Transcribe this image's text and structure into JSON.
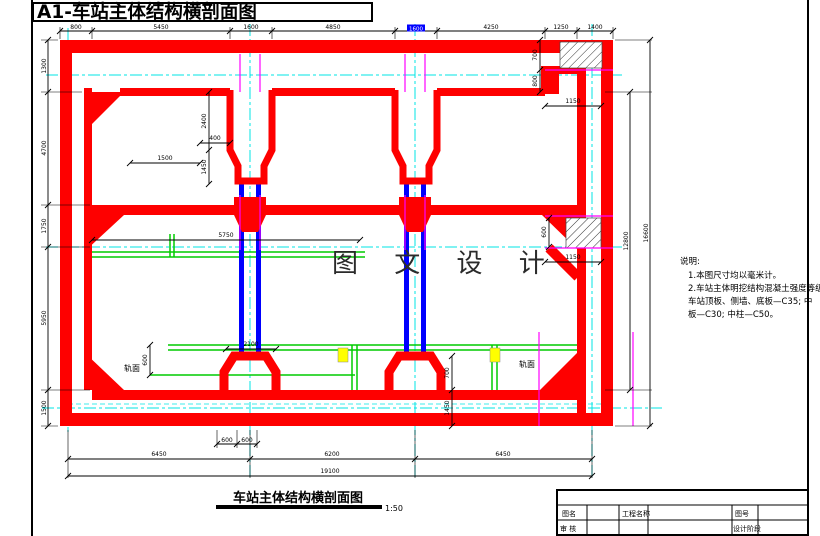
{
  "sheet": {
    "title": "A1-车站主体结构横剖面图",
    "caption": "车站主体结构横剖面图",
    "scale": "1:50",
    "watermark": "图 文 设 计"
  },
  "notes": {
    "heading": "说明:",
    "line1": "1.本图尺寸均以毫米计。",
    "line2": "2.车站主体明挖结构混凝土强度等级:",
    "line3": "车站顶板、侧墙、底板—C35; 中",
    "line4": "板—C30; 中柱—C50。"
  },
  "labels": {
    "rail_left": "轨面",
    "rail_right": "轨面"
  },
  "title_block": {
    "drawing_name": "图名",
    "project_name": "工程名称",
    "drawing_no": "图号",
    "review": "审 核",
    "design_stage": "设计阶段"
  },
  "colors": {
    "structure": "#fe0000",
    "column": "#0000fe",
    "centerline": "#00e5e5",
    "joint": "#ff00ff",
    "track": "#00cc00",
    "pad": "#ffff00"
  },
  "dimensions": {
    "top": [
      "800",
      "5450",
      "1600",
      "4850",
      "1600",
      "4250",
      "1250",
      "1400"
    ],
    "left": [
      "1300",
      "4700",
      "1750",
      "5950",
      "1500"
    ],
    "right_inner": "12800",
    "right_outer": "16600",
    "bottom_small": [
      "600",
      "600"
    ],
    "bottom_spans": [
      "6450",
      "6200",
      "6450"
    ],
    "bottom_overall": "19100",
    "inner": {
      "beam_upper": "2400",
      "beam_lower": "1450",
      "haunch_len": "1500",
      "haunch_off": "400",
      "mid_span": "5750",
      "corner_v1": "700",
      "corner_v2": "800",
      "corner_h": "1150",
      "hatch_v": "600",
      "hatch_h": "1150",
      "plinth_w": "2100",
      "plinth_h": "700",
      "slab_t": "1450",
      "rail_h": "600"
    }
  }
}
